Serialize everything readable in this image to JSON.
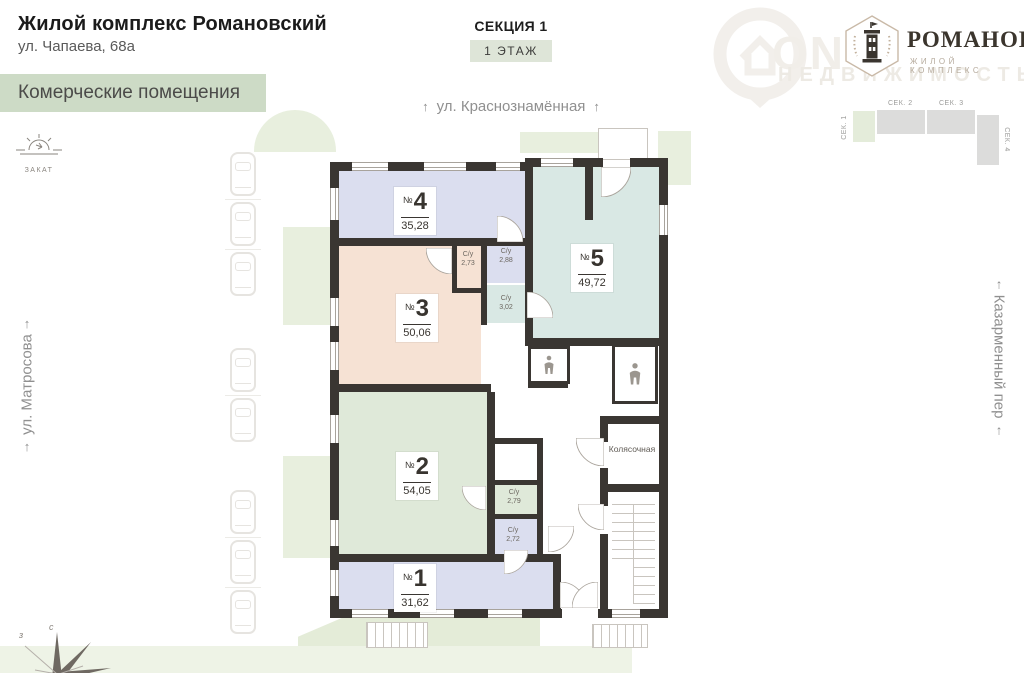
{
  "header": {
    "title": "Жилой комплекс Романовский",
    "address": "ул. Чапаева, 68а",
    "banner": "Комерческие помещения",
    "section": "СЕКЦИЯ 1",
    "floor_badge": "1 ЭТАЖ",
    "sunset_label": "ЗАКАТ"
  },
  "logo": {
    "name": "РОМАНОВСКИЙ",
    "subtitle": "ЖИЛОЙ КОМПЛЕКС"
  },
  "watermark": {
    "big": "ON",
    "small": "НЕДВИЖИМОСТЬ"
  },
  "section_map": {
    "items": [
      {
        "label": "СЕК. 1",
        "active": true
      },
      {
        "label": "СЕК. 2",
        "active": false
      },
      {
        "label": "СЕК. 3",
        "active": false
      },
      {
        "label": "СЕК. 4",
        "active": false
      }
    ],
    "active_color": "#e4ecda",
    "inactive_color": "#dcdcdb"
  },
  "streets": {
    "top": "ул. Краснознамённая",
    "left": "ул. Матросова",
    "right": "Казарменный пер",
    "arrow": "↑"
  },
  "plan": {
    "wall_color": "#3a3632",
    "number_sign": "№",
    "rooms": [
      {
        "number": "1",
        "area": "31,62",
        "color": "#dbdeef"
      },
      {
        "number": "2",
        "area": "54,05",
        "color": "#dfe9d9"
      },
      {
        "number": "3",
        "area": "50,06",
        "color": "#f6e2d4"
      },
      {
        "number": "4",
        "area": "35,28",
        "color": "#dbdeef"
      },
      {
        "number": "5",
        "area": "49,72",
        "color": "#d9e8e4"
      }
    ],
    "bathrooms": [
      {
        "label": "С/у",
        "area": "2,73"
      },
      {
        "label": "С/у",
        "area": "2,88"
      },
      {
        "label": "С/у",
        "area": "3,02"
      },
      {
        "label": "С/у",
        "area": "2,79"
      },
      {
        "label": "С/у",
        "area": "2,72"
      }
    ],
    "stroller_room": "Колясочная"
  },
  "compass": {
    "w": "з",
    "n": "с"
  }
}
